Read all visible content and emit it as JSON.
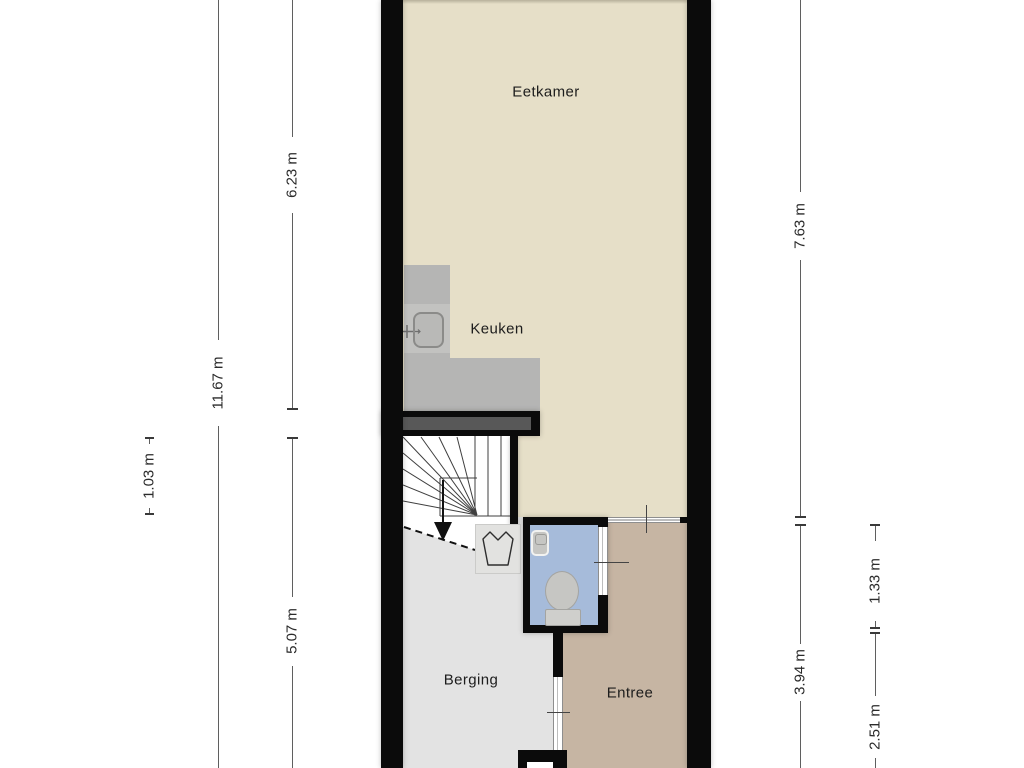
{
  "rooms": {
    "eetkamer": {
      "label": "Eetkamer"
    },
    "keuken": {
      "label": "Keuken"
    },
    "berging": {
      "label": "Berging"
    },
    "entree": {
      "label": "Entree"
    }
  },
  "dimensions": {
    "left_total": "11.67 m",
    "left_upper": "6.23 m",
    "left_stair": "1.03 m",
    "left_lower": "5.07 m",
    "right_upper": "7.63 m",
    "right_toilet": "1.33 m",
    "right_lower": "3.94 m",
    "right_hall": "2.51 m"
  },
  "icons": [
    "kitchen-sink-icon",
    "kitchen-faucet-icon",
    "stairs-down-arrow-icon",
    "washing-machine-icon",
    "hand-basin-icon",
    "toilet-icon"
  ],
  "colors": {
    "wall": "#0b0b0b",
    "eetkamer": "#e6dfc8",
    "berging": "#e3e3e3",
    "entree": "#c6b5a3",
    "toilet": "#a6bbda",
    "counter": "#b5b5b4",
    "counter_module": "#c2c2c0",
    "kitchen_wall_inset": "#585858",
    "washer": "#e2e2e0",
    "fixture": "#c6c6c3",
    "dimension_line": "#5f5f5f",
    "text": "#1d1d1d"
  }
}
